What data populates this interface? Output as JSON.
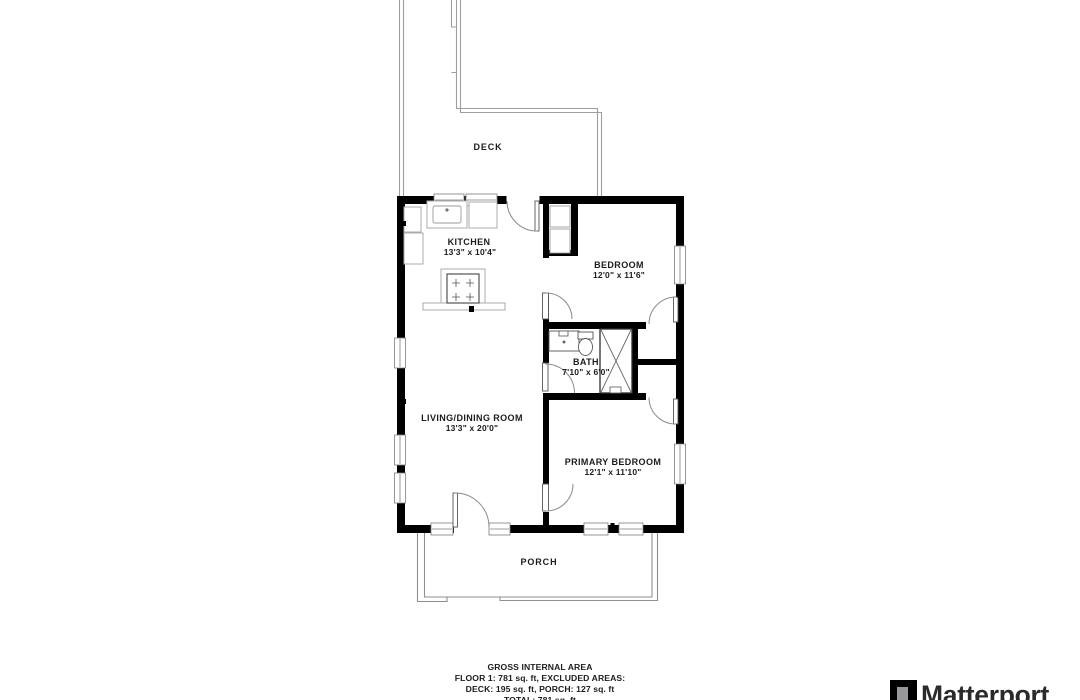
{
  "plan": {
    "areas": {
      "deck_label": "DECK",
      "porch_label": "PORCH"
    },
    "rooms": [
      {
        "name": "KITCHEN",
        "dims": "13'3\" x 10'4\""
      },
      {
        "name": "BEDROOM",
        "dims": "12'0\" x 11'6\""
      },
      {
        "name": "BATH",
        "dims": "7'10\" x 6'0\""
      },
      {
        "name": "LIVING/DINING ROOM",
        "dims": "13'3\" x 20'0\""
      },
      {
        "name": "PRIMARY BEDROOM",
        "dims": "12'1\" x 11'10\""
      }
    ]
  },
  "footer": {
    "lines": [
      "GROSS INTERNAL AREA",
      "FLOOR 1: 781 sq. ft, EXCLUDED AREAS:",
      "DECK: 195 sq. ft, PORCH: 127 sq. ft",
      "TOTAL: 781 sq. ft"
    ]
  },
  "branding": {
    "logo_text": "Matterport"
  },
  "colors": {
    "wall": "#000000",
    "thin_line": "#9e9e9e",
    "logo_gray": "#98989a",
    "text": "#1c1c1c"
  }
}
